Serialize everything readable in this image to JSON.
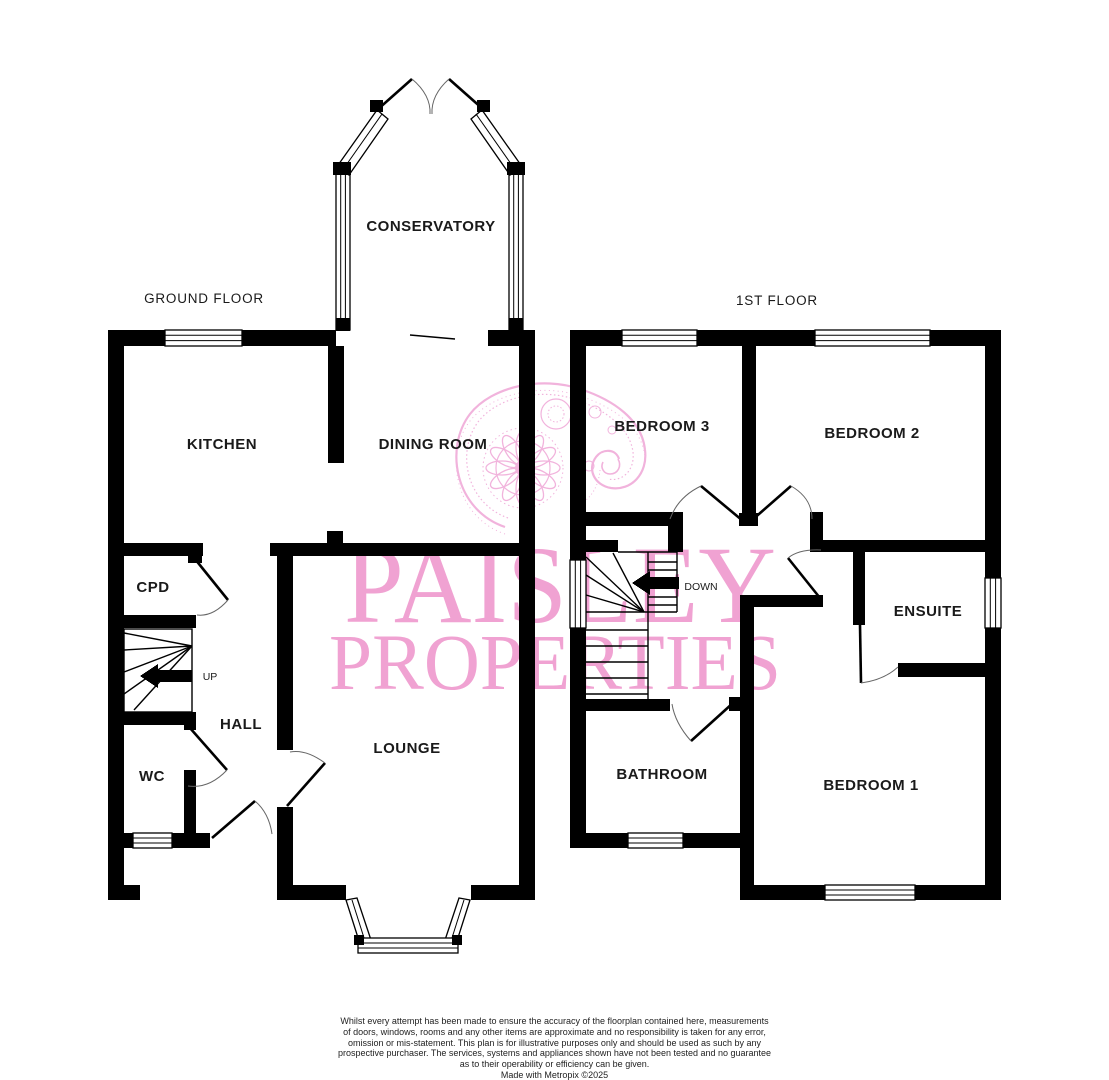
{
  "ground_floor": {
    "title": "GROUND FLOOR",
    "up_label": "UP",
    "rooms": {
      "conservatory": "CONSERVATORY",
      "kitchen": "KITCHEN",
      "dining_room": "DINING ROOM",
      "cpd": "CPD",
      "hall": "HALL",
      "wc": "WC",
      "lounge": "LOUNGE"
    }
  },
  "first_floor": {
    "title": "1ST FLOOR",
    "down_label": "DOWN",
    "rooms": {
      "bedroom3": "BEDROOM 3",
      "bedroom2": "BEDROOM 2",
      "ensuite": "ENSUITE",
      "bathroom": "BATHROOM",
      "bedroom1": "BEDROOM 1"
    }
  },
  "watermark": {
    "line1": "PAISLEY",
    "line2": "PROPERTIES",
    "color": "#EF9FD0"
  },
  "footer": {
    "disclaimer_lines": [
      "Whilst every attempt has been made to ensure the accuracy of the floorplan contained here, measurements",
      "of doors, windows, rooms and any other items are approximate and no responsibility is taken for any error,",
      "omission or mis-statement. This plan is for illustrative purposes only and should be used as such by any",
      "prospective purchaser. The services, systems and appliances shown have not been tested and no guarantee",
      "as to their operability or efficiency can be given."
    ],
    "credit": "Made with Metropix ©2025"
  }
}
